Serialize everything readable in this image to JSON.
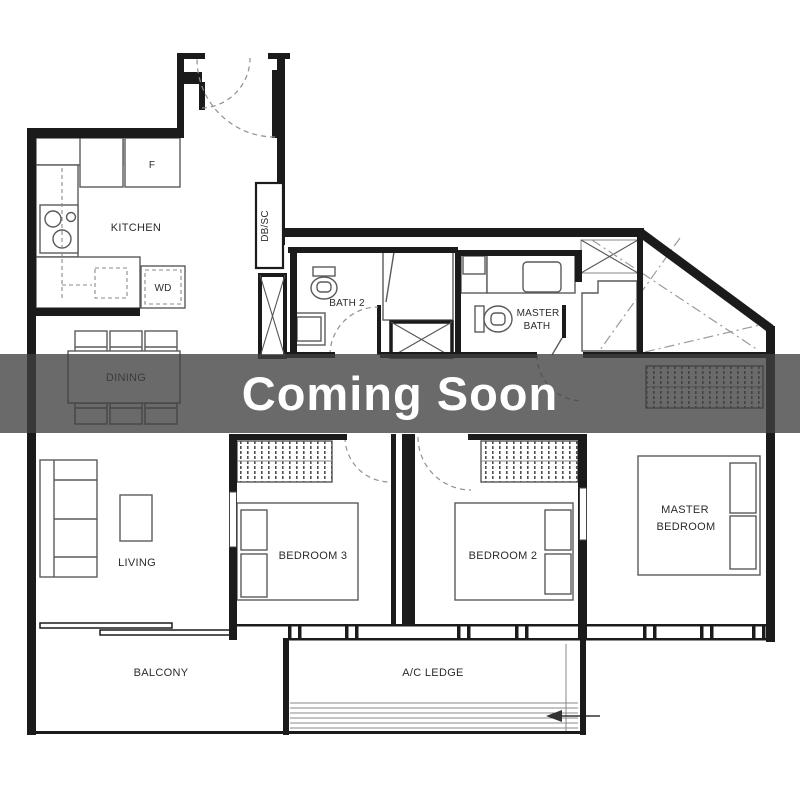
{
  "banner": {
    "label": "Coming Soon"
  },
  "rooms": {
    "kitchen": {
      "label": "KITCHEN"
    },
    "dining": {
      "label": "DINING"
    },
    "living": {
      "label": "LIVING"
    },
    "bedroom3": {
      "label": "BEDROOM 3"
    },
    "bedroom2": {
      "label": "BEDROOM 2"
    },
    "master_bedroom": {
      "label_line1": "MASTER",
      "label_line2": "BEDROOM"
    },
    "bath2": {
      "label": "BATH 2"
    },
    "master_bath": {
      "label_line1": "MASTER",
      "label_line2": "BATH"
    },
    "balcony": {
      "label": "BALCONY"
    },
    "ac_ledge": {
      "label": "A/C LEDGE"
    }
  },
  "fixtures": {
    "fridge": {
      "label": "F"
    },
    "washer_dryer": {
      "label": "WD"
    },
    "db_sc": {
      "label": "DB/SC"
    }
  },
  "colors": {
    "wall": "#1b1b1b",
    "furniture_line": "#5a5a5a",
    "banner_bg": "rgba(64,64,64,0.78)",
    "banner_text": "#ffffff",
    "background": "#ffffff"
  }
}
